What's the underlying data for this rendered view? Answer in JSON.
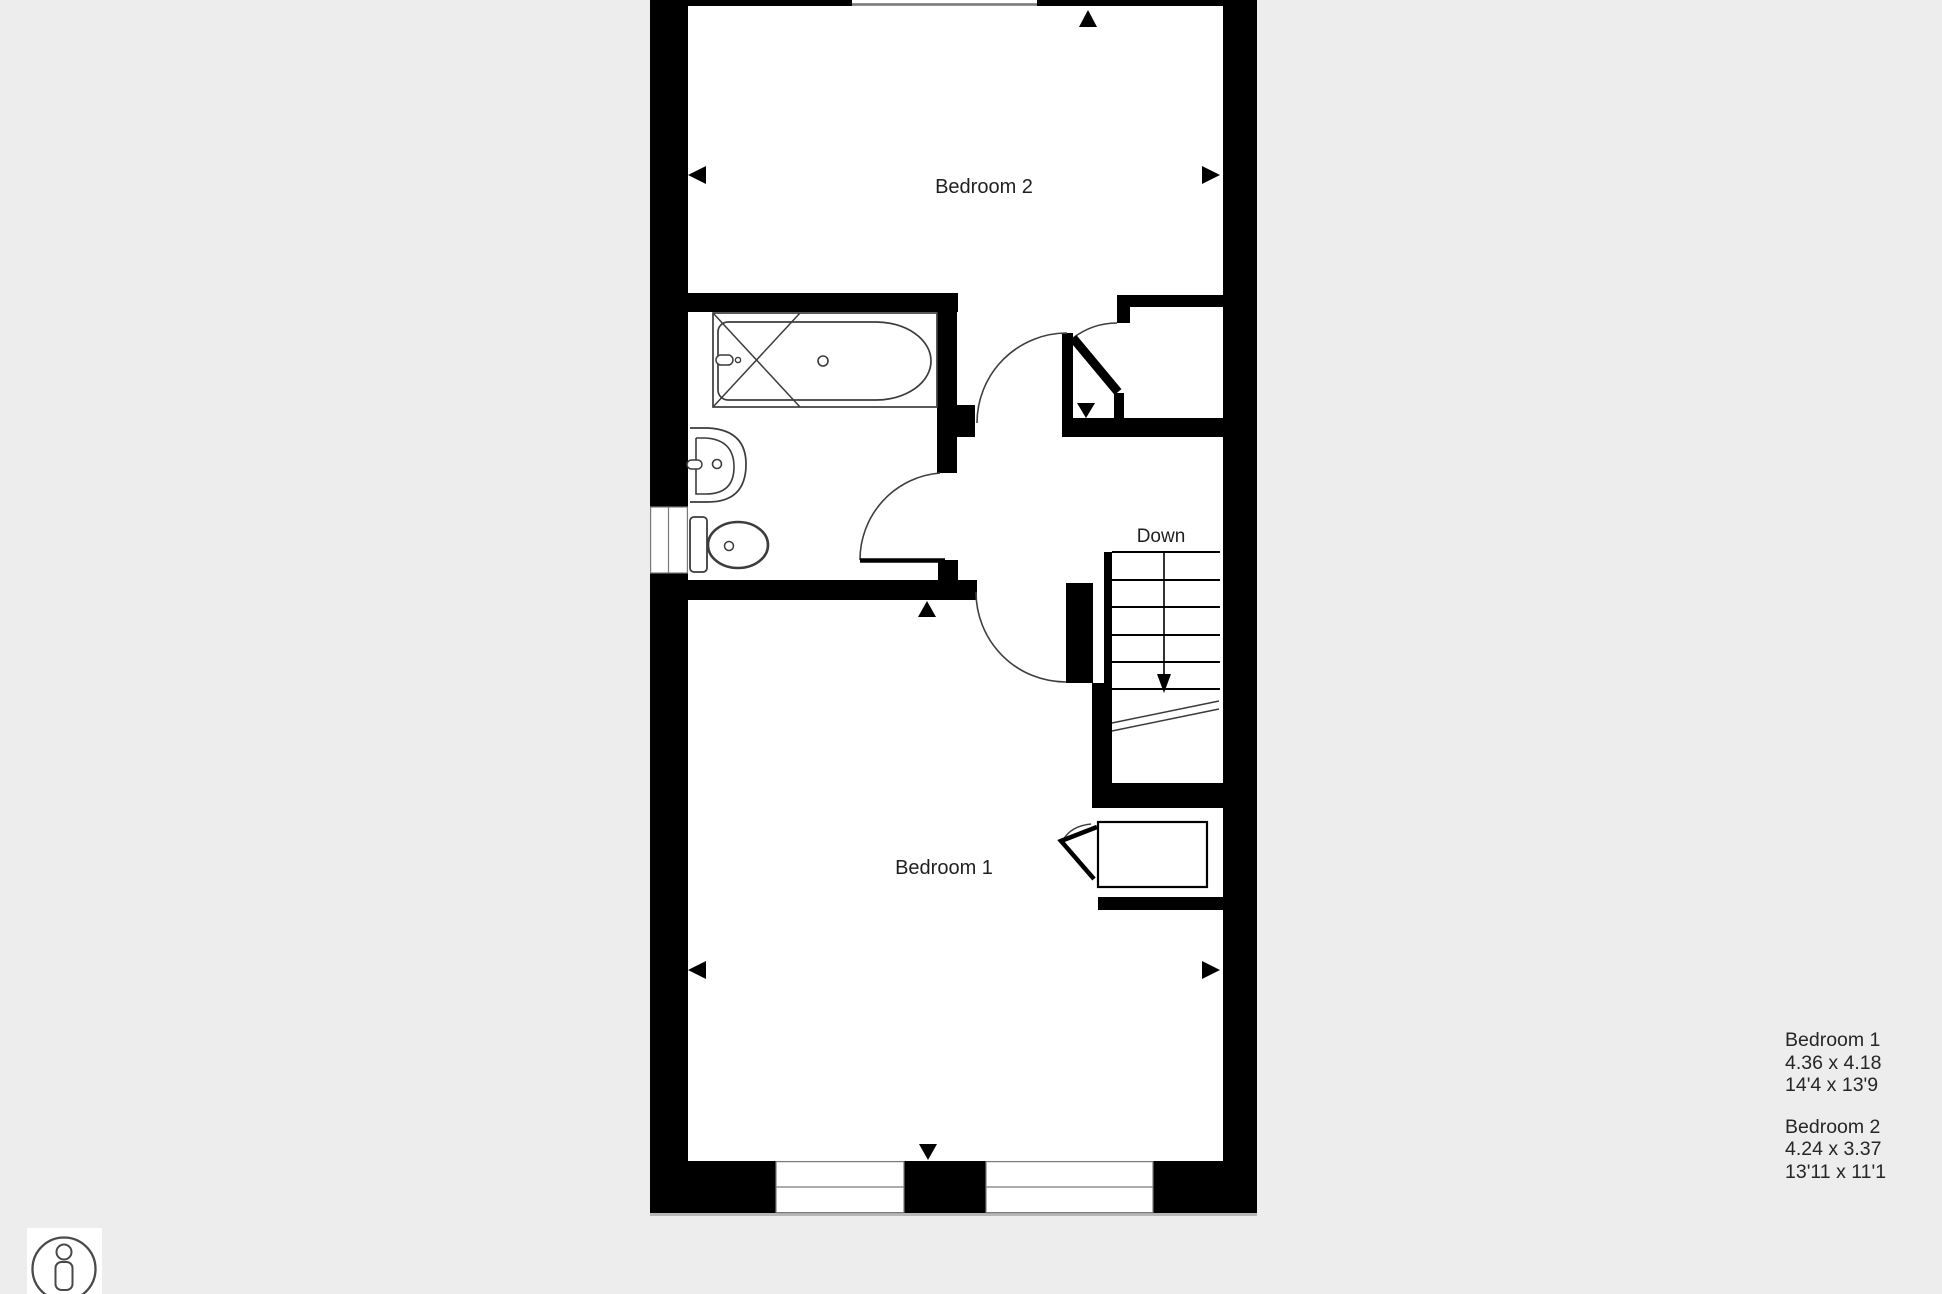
{
  "plan": {
    "rooms": {
      "bedroom2": {
        "label": "Bedroom 2"
      },
      "bedroom1": {
        "label": "Bedroom 1"
      }
    },
    "stairs": {
      "direction_label": "Down"
    }
  },
  "legend": {
    "entries": [
      {
        "name": "Bedroom 1",
        "metric": "4.36 x 4.18",
        "imperial": "14'4 x 13'9"
      },
      {
        "name": "Bedroom 2",
        "metric": "4.24 x 3.37",
        "imperial": "13'11 x 11'1"
      }
    ]
  },
  "icons": {
    "person_scale": "person-scale-icon"
  },
  "colors": {
    "background": "#ededed",
    "paper": "#ffffff",
    "wall": "#000000",
    "fixture_line": "#3c3c3c",
    "window_line": "#7a7a7a",
    "text": "#262626"
  }
}
